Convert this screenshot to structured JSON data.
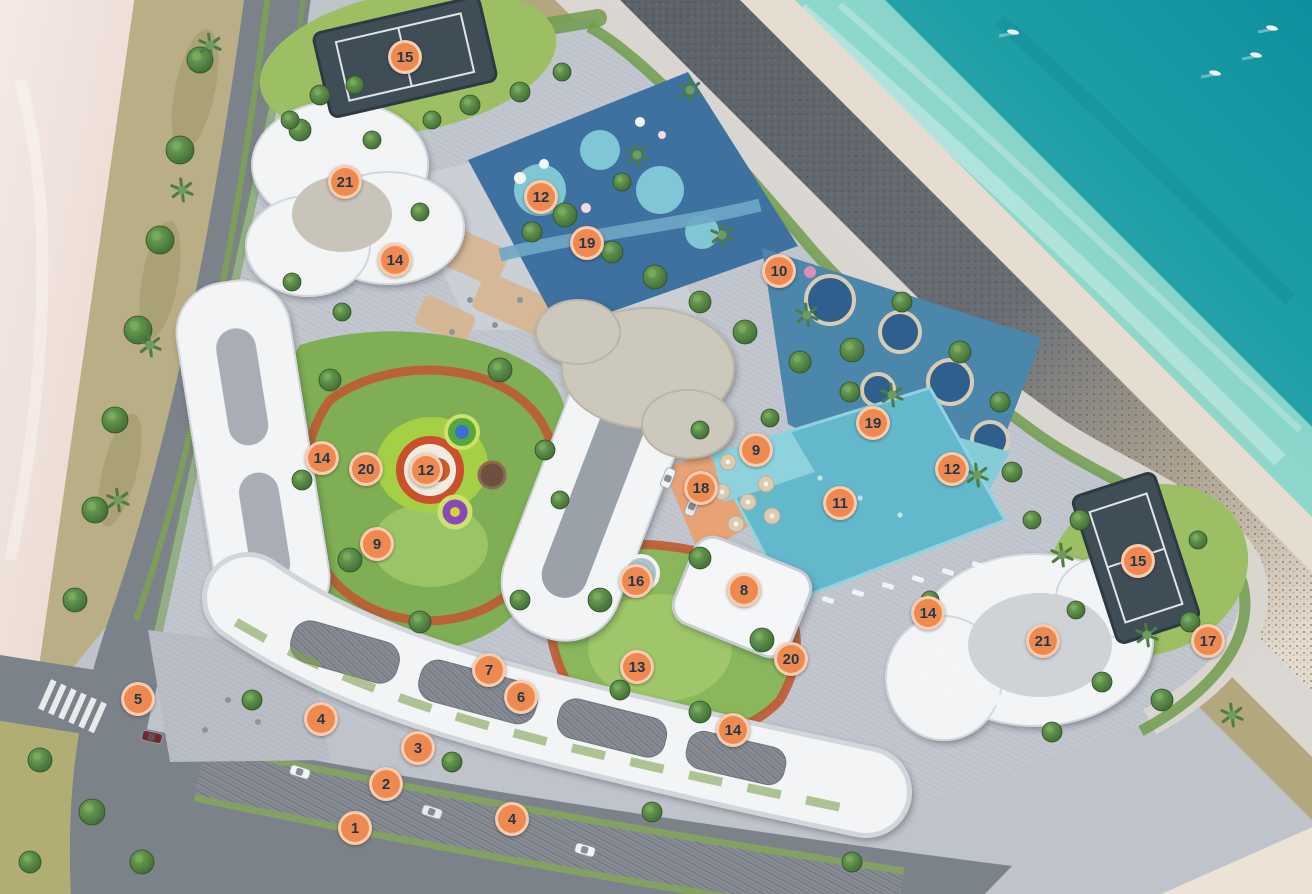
{
  "view": {
    "width": 1312,
    "height": 894,
    "title": "Beachfront resort master plan — aerial rendering with numbered amenity markers"
  },
  "palette": {
    "marker_fill": "#EE8A4F",
    "marker_ring": "rgba(252,231,212,0.72)",
    "marker_text": "#1D3950",
    "ocean_deep": "#0E8F9E",
    "ocean_shallow": "#63C6BF",
    "beach_sand": "#F2E5DF",
    "breakwater_rock": "#5D6269",
    "promenade": "#DAD7D2",
    "road_asphalt": "#7C828A",
    "campus_paving": "#C2C6CE",
    "lawn_green": "#8AB75C",
    "pool_blue": "#64B8CB",
    "waterpark_blue": "#3E70A0",
    "building_white": "#F3F4F6",
    "running_track": "#C05A33",
    "sports_court": "#3F4D57"
  },
  "markers": [
    {
      "id": "1",
      "label": "1",
      "x": 355,
      "y": 828
    },
    {
      "id": "2",
      "label": "2",
      "x": 386,
      "y": 784
    },
    {
      "id": "3",
      "label": "3",
      "x": 418,
      "y": 748
    },
    {
      "id": "4a",
      "label": "4",
      "x": 321,
      "y": 719
    },
    {
      "id": "4b",
      "label": "4",
      "x": 512,
      "y": 819
    },
    {
      "id": "5",
      "label": "5",
      "x": 138,
      "y": 699
    },
    {
      "id": "6",
      "label": "6",
      "x": 521,
      "y": 697
    },
    {
      "id": "7",
      "label": "7",
      "x": 489,
      "y": 670
    },
    {
      "id": "8",
      "label": "8",
      "x": 744,
      "y": 590
    },
    {
      "id": "9a",
      "label": "9",
      "x": 377,
      "y": 544
    },
    {
      "id": "9b",
      "label": "9",
      "x": 756,
      "y": 450
    },
    {
      "id": "10",
      "label": "10",
      "x": 779,
      "y": 271
    },
    {
      "id": "11",
      "label": "11",
      "x": 840,
      "y": 503
    },
    {
      "id": "12a",
      "label": "12",
      "x": 541,
      "y": 197
    },
    {
      "id": "12b",
      "label": "12",
      "x": 426,
      "y": 470
    },
    {
      "id": "12c",
      "label": "12",
      "x": 952,
      "y": 469
    },
    {
      "id": "13",
      "label": "13",
      "x": 637,
      "y": 667
    },
    {
      "id": "14a",
      "label": "14",
      "x": 395,
      "y": 260
    },
    {
      "id": "14b",
      "label": "14",
      "x": 322,
      "y": 458
    },
    {
      "id": "14c",
      "label": "14",
      "x": 733,
      "y": 730
    },
    {
      "id": "14d",
      "label": "14",
      "x": 928,
      "y": 613
    },
    {
      "id": "15a",
      "label": "15",
      "x": 405,
      "y": 57
    },
    {
      "id": "15b",
      "label": "15",
      "x": 1138,
      "y": 561
    },
    {
      "id": "16",
      "label": "16",
      "x": 636,
      "y": 581
    },
    {
      "id": "17",
      "label": "17",
      "x": 1208,
      "y": 641
    },
    {
      "id": "18",
      "label": "18",
      "x": 701,
      "y": 488
    },
    {
      "id": "19a",
      "label": "19",
      "x": 587,
      "y": 243
    },
    {
      "id": "19b",
      "label": "19",
      "x": 873,
      "y": 423
    },
    {
      "id": "20a",
      "label": "20",
      "x": 366,
      "y": 469
    },
    {
      "id": "20b",
      "label": "20",
      "x": 791,
      "y": 659
    },
    {
      "id": "21a",
      "label": "21",
      "x": 345,
      "y": 182
    },
    {
      "id": "21b",
      "label": "21",
      "x": 1043,
      "y": 641
    }
  ]
}
